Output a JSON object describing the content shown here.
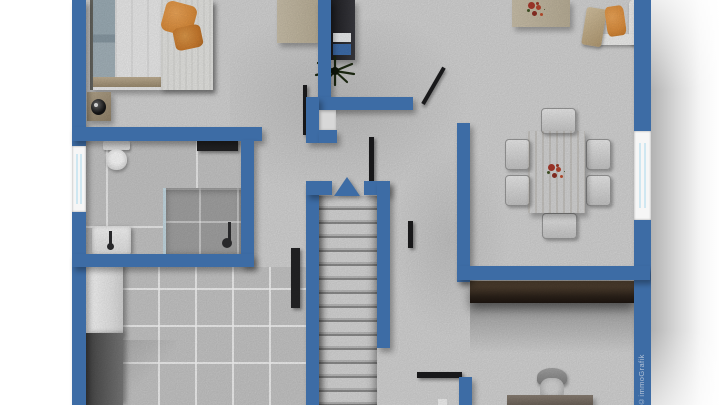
{
  "watermark": {
    "text": "©immoGrafik"
  },
  "colors": {
    "wall": "#3d6ca5",
    "floor": "#d8d8d8",
    "floor_bath": "#c9c9c9",
    "floor_kitchen": "#c9c9c9",
    "shower": "#a5a5a5",
    "glass": "#cfe7f1",
    "wood_light": "#cdc3ad",
    "orange": "#e0913f",
    "orange_deep": "#cd7c2e",
    "red_flower": "#a9392c",
    "accent_blue": "#3f6fae",
    "black_door": "#1c1c1e",
    "text_watermark": "#c6d0df"
  },
  "icons": [
    "bed",
    "nightstand",
    "table-lamp",
    "desk",
    "shelf",
    "plant",
    "coffee-table",
    "corner-sofa",
    "orange-pillow",
    "dining-table",
    "dining-chair",
    "flower-centerpiece",
    "toilet",
    "sink",
    "shower",
    "radiator",
    "kitchen-appliance",
    "kitchen-counter",
    "tall-cabinet",
    "staircase",
    "north-arrow",
    "door-leaf",
    "window",
    "sideboard",
    "office-chair",
    "office-desk"
  ]
}
